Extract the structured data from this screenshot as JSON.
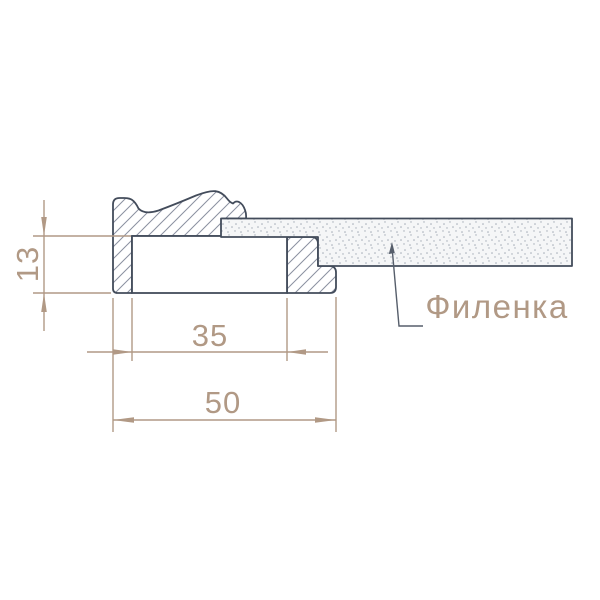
{
  "drawing": {
    "callout": {
      "label": "Филенка"
    },
    "dimensions": {
      "rabbet_height": "13",
      "opening_width": "35",
      "overall_width": "50"
    }
  },
  "colors": {
    "background": "#ffffff",
    "outline": "#434c5b",
    "hatch": "#8a90a0",
    "stipple-dot": "#a3abb6",
    "stipple-bg": "#f5f6f7",
    "dimension": "#b19985",
    "leader": "#565e6b"
  }
}
